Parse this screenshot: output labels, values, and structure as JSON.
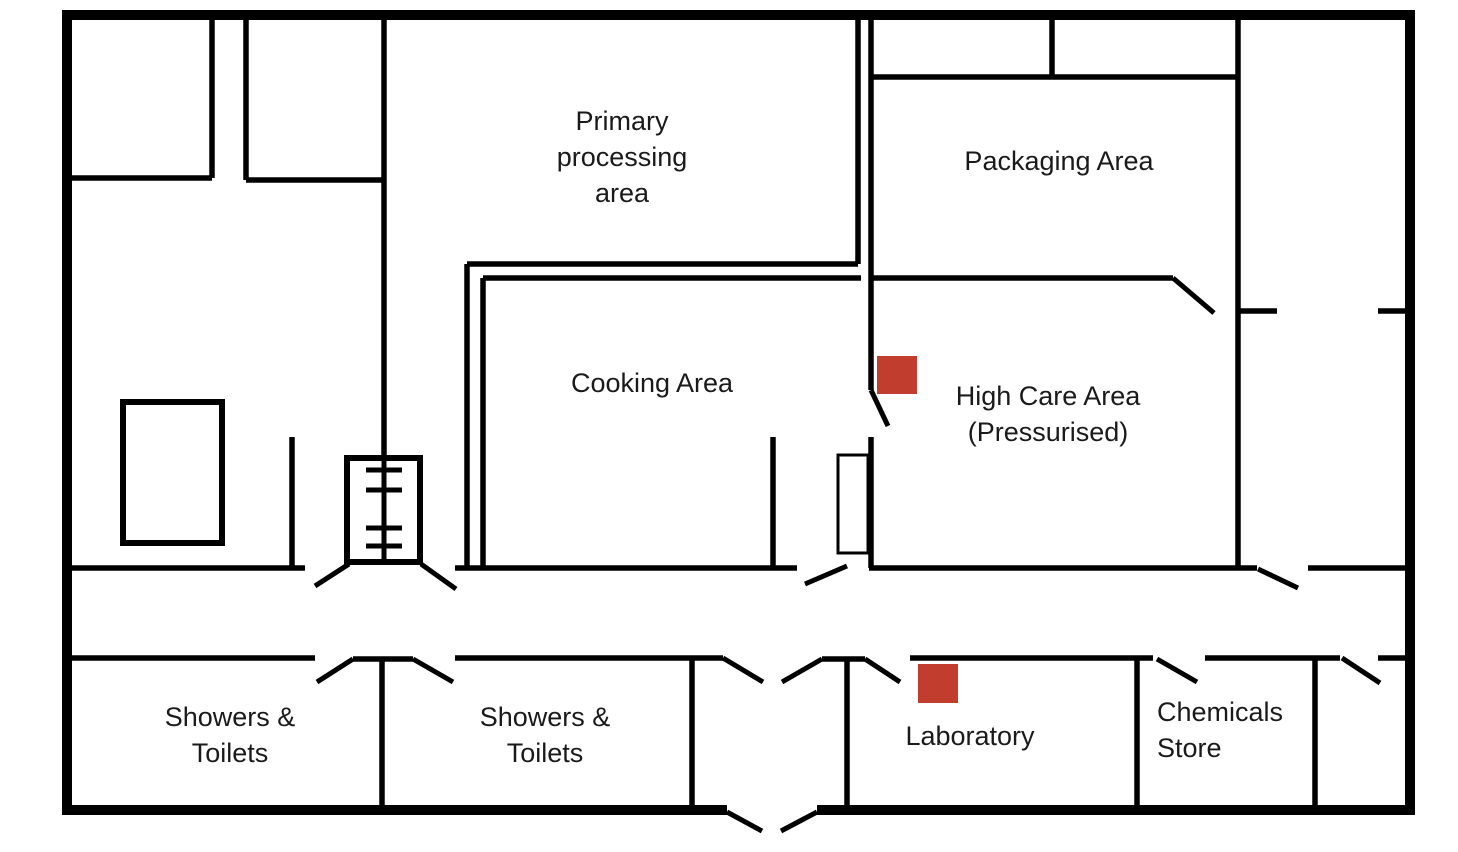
{
  "floor_plan": {
    "title": "Food processing facility floor plan",
    "colors": {
      "wall": "#000000",
      "text": "#1a1a1a",
      "marker": "#c13d2e",
      "background": "#ffffff"
    },
    "rooms": {
      "primary_processing": {
        "lines": [
          "Primary",
          "processing",
          "area"
        ]
      },
      "packaging": {
        "lines": [
          "Packaging Area"
        ]
      },
      "cooking": {
        "lines": [
          "Cooking Area"
        ]
      },
      "high_care": {
        "lines": [
          "High Care Area",
          "(Pressurised)"
        ]
      },
      "showers_toilets_1": {
        "lines": [
          "Showers &",
          "Toilets"
        ]
      },
      "showers_toilets_2": {
        "lines": [
          "Showers &",
          "Toilets"
        ]
      },
      "laboratory": {
        "lines": [
          "Laboratory"
        ]
      },
      "chemicals_store": {
        "lines": [
          "Chemicals",
          "Store"
        ]
      }
    },
    "markers": [
      {
        "name": "high-care-marker"
      },
      {
        "name": "laboratory-marker"
      }
    ]
  }
}
